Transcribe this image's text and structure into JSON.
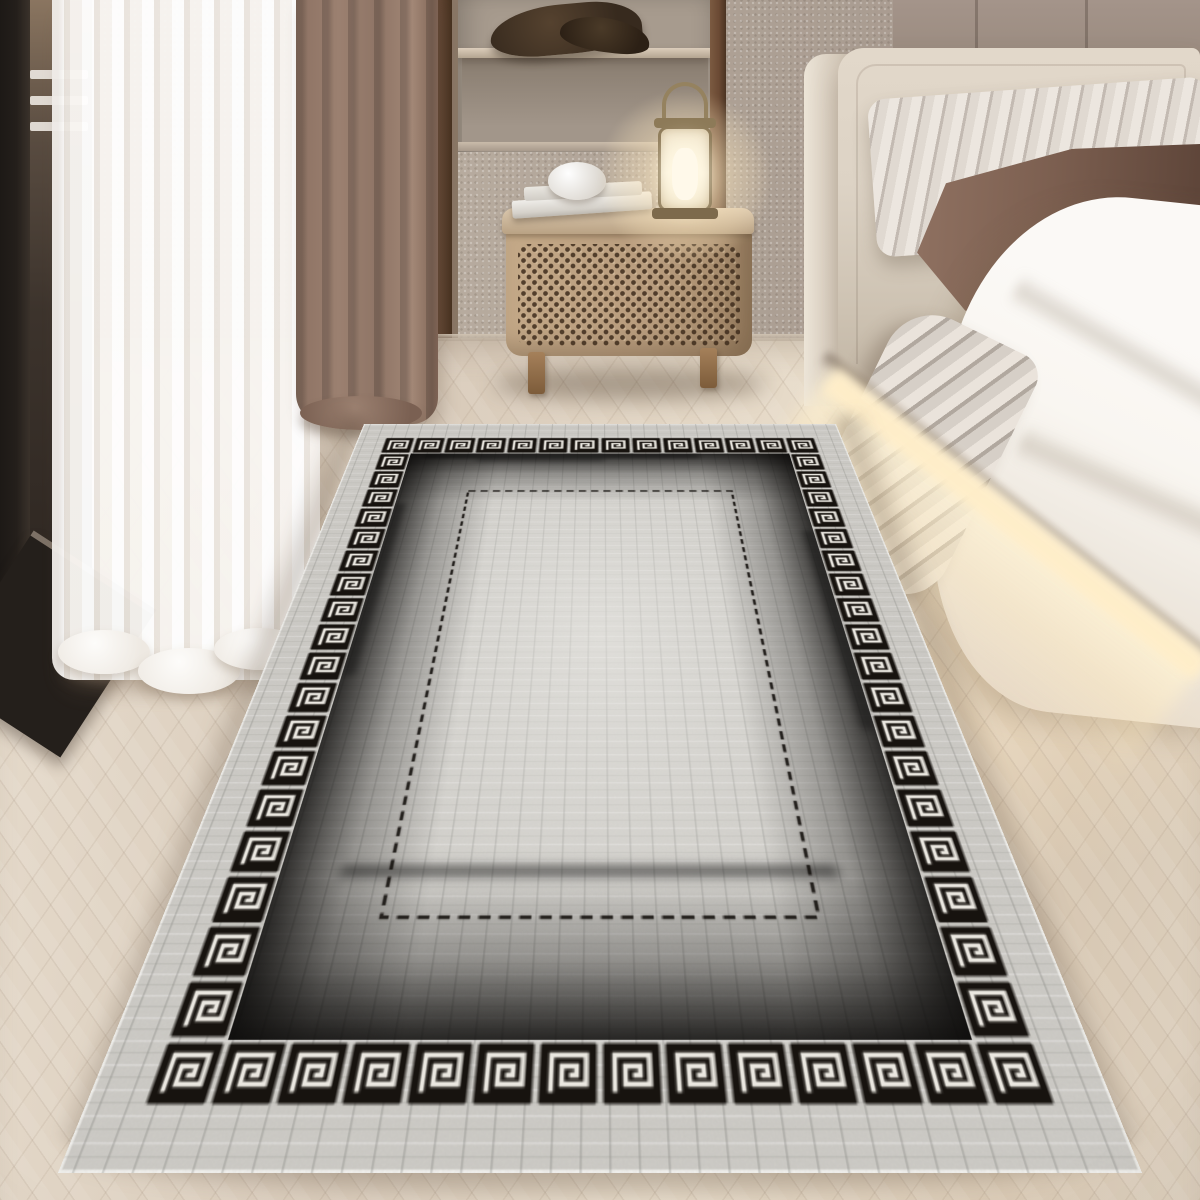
{
  "meta": {
    "title": "Bedroom lifestyle photo of a distressed grey rug with black Greek-key border",
    "image_type": "product photograph, no visible text",
    "text_content": "none"
  },
  "palette": {
    "wall": "#b3a79b",
    "wall_dark": "#a2948a",
    "panel": "#a4948a",
    "niche": "#a79b8e",
    "shelf": "#dccdbb",
    "bowl": "#372a1e",
    "post": "#6b4a34",
    "trim": "#5d4230",
    "door": "#241f1b",
    "sheer": "#f8f5f1",
    "curtain": "#9b8070",
    "curtain_dark": "#7e6354",
    "floor": "#ddd0c0",
    "floor_warm": "#ecdfc9",
    "cane": "#b89c7d",
    "wood_leg": "#a5805a",
    "candle": "#fff9ea",
    "headboard": "#ddd3c5",
    "headboard_side": "#ece4d7",
    "stripe_light": "#ece6df",
    "stripe_dark": "#c3bab2",
    "pillow_brown": "#7c5f50",
    "pillow_brown_dark": "#5f463a",
    "duvet": "#f9f6f1",
    "glow": "#ffeec9",
    "rug_base": "#cdcbc6",
    "rug_key": "#17130f",
    "rug_key_line": "#eae7e0",
    "rug_fade": "#0a0908",
    "rug_dash": "#161310"
  },
  "scene": {
    "room": "modern bedroom with beige textured plaster walls and light oak herringbone floor",
    "left_side": {
      "door": "dark-framed glass balcony door with white railing glimpse",
      "sheer_curtain": "white voile curtain pooling on the floor",
      "accent_curtain": "taupe blackout curtain panel",
      "trim": "dark walnut vertical door trim"
    },
    "back_wall": {
      "niche": "recessed open shelf with dark driftwood bowl sculpture",
      "post": "dark wood column beside niche",
      "panels": "taupe upholstered headboard wall panels with vertical seams"
    },
    "furniture": {
      "nightstand": "rattan cane bedside cabinet with tapered wood legs",
      "nightstand_items": [
        "stack of white books",
        "round white trinket",
        "glowing candle lantern with arched handle"
      ],
      "bed": "cream upholstered bed, grey striped pillow, brown karate-chop pillow, white duvet, striped throw draped over edge",
      "lighting": "warm under-bed LED glow strip reflecting on floor"
    },
    "rug": {
      "style": "distressed grey runner rug, Versace-style black Greek-key meander border",
      "border_motif": "greek-key spiral squares on black ground with light lines",
      "motif_grid": {
        "columns": 14,
        "rows": 20
      },
      "inner_border": "thin black dashed rectangle",
      "effects": [
        "black ikat fade bleeding inward from border",
        "woven crosshatch distressed texture",
        "lighter abraded center"
      ],
      "perspective": "laid diagonally into depth, foreshortened toward top"
    }
  }
}
